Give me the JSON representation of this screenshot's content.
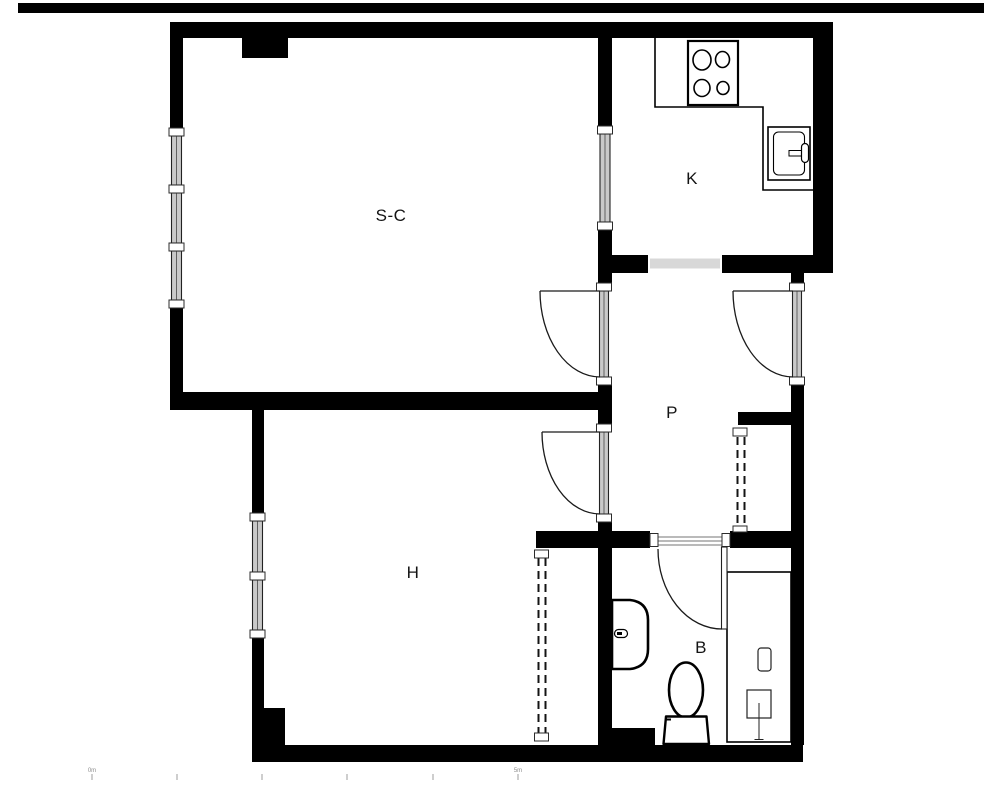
{
  "rooms": [
    {
      "id": "living-dining",
      "label": "S-C"
    },
    {
      "id": "kitchen",
      "label": "K"
    },
    {
      "id": "hallway",
      "label": "P"
    },
    {
      "id": "bedroom",
      "label": "H"
    },
    {
      "id": "bathroom",
      "label": "B"
    }
  ],
  "scale_bar": {
    "start_label": "0m",
    "end_label": "5m",
    "tick_count": 6
  },
  "colors": {
    "wall": "#000000",
    "door_threshold": "#d8d8d8",
    "window_glass": "#c9c9c9",
    "line": "#1a1a1a",
    "page_rule": "#000000"
  }
}
